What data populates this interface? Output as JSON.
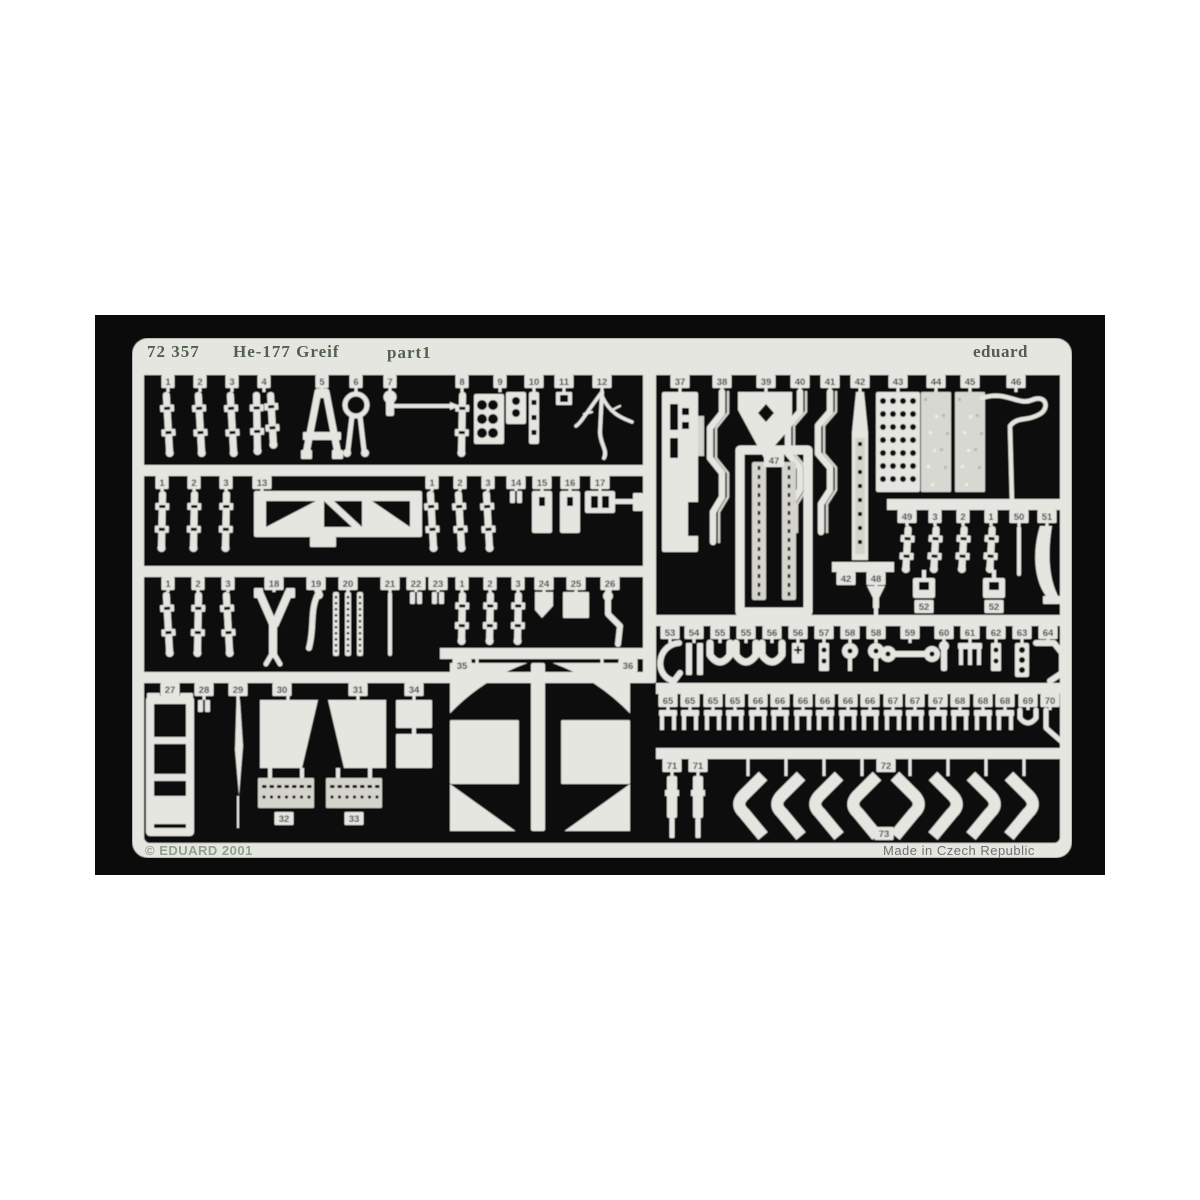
{
  "header": {
    "catalog_number": "72 357",
    "title": "He-177 Greif",
    "part_label": "part1",
    "brand": "eduard"
  },
  "footer": {
    "copyright": "© EDUARD 2001",
    "made_in": "Made in Czech Republic"
  },
  "colors": {
    "page_bg": "#ffffff",
    "photo_bg": "#0b0b0b",
    "metal": "#e6e6e1",
    "metal_dim": "#d4d4cc",
    "etch_dark": "#101010",
    "header_text": "#525f52",
    "brand_text": "#545c54",
    "copyright_text": "#8fa08f",
    "origin_text": "#6f6f6f",
    "number_text": "#3c3c3c"
  },
  "fret": {
    "sheet": {
      "w": 940,
      "h": 520,
      "frame": 12,
      "top_band": 26,
      "bottom_band": 15,
      "corner_radius": 16
    },
    "extras": [
      {
        "k": "rect",
        "x": 511,
        "y": 26,
        "w": 13,
        "h": 319
      },
      {
        "k": "rect",
        "x": 399,
        "y": 325,
        "w": 14,
        "h": 168
      },
      {
        "k": "frame47",
        "n": "47",
        "x": 608,
        "y": 112,
        "w": 68,
        "h": 162
      }
    ],
    "rows": [
      {
        "name": "row-a",
        "rail": [
          12,
          26,
          916,
          11
        ],
        "partY": 54,
        "parts": [
          {
            "n": "1",
            "k": "strap",
            "cx": 36,
            "h": 64
          },
          {
            "n": "2",
            "k": "strap",
            "cx": 68,
            "h": 64
          },
          {
            "n": "3",
            "k": "strap",
            "cx": 100,
            "h": 64
          },
          {
            "n": "4",
            "k": "strap2",
            "cx": 132,
            "h": 62
          },
          {
            "n": "5",
            "k": "aframe",
            "cx": 190
          },
          {
            "n": "6",
            "k": "ring",
            "cx": 224
          },
          {
            "n": "7",
            "k": "lever",
            "cx": 258
          },
          {
            "n": "8",
            "k": "strap",
            "cx": 330,
            "h": 64
          },
          {
            "n": "9",
            "k": "panel",
            "cx": 368
          },
          {
            "n": "10",
            "k": "strip",
            "cx": 402
          },
          {
            "n": "11",
            "k": "box",
            "cx": 432
          },
          {
            "n": "12",
            "k": "tree",
            "cx": 470
          }
        ]
      },
      {
        "name": "row-b",
        "rail": [
          12,
          127,
          506,
          11
        ],
        "partY": 153,
        "parts": [
          {
            "n": "1",
            "k": "strap",
            "cx": 30,
            "h": 60
          },
          {
            "n": "2",
            "k": "strap",
            "cx": 62,
            "h": 60
          },
          {
            "n": "3",
            "k": "strap",
            "cx": 94,
            "h": 60
          },
          {
            "n": "13",
            "k": "truss",
            "x": 122,
            "w": 168,
            "h": 46,
            "tabCx": 130,
            "sx": 130
          },
          {
            "n": "1",
            "k": "strap",
            "cx": 300,
            "h": 60
          },
          {
            "n": "2",
            "k": "strap",
            "cx": 328,
            "h": 60
          },
          {
            "n": "3",
            "k": "strap",
            "cx": 356,
            "h": 60
          },
          {
            "n": "14",
            "k": "tiny",
            "cx": 384
          },
          {
            "n": "15",
            "k": "rectp",
            "cx": 410,
            "w": 20,
            "h": 42
          },
          {
            "n": "16",
            "k": "rectp",
            "cx": 438,
            "w": 20,
            "h": 42
          },
          {
            "n": "17",
            "k": "bracket17",
            "cx": 468
          }
        ]
      },
      {
        "name": "row-c",
        "rail": [
          12,
          228,
          506,
          11
        ],
        "partY": 254,
        "parts": [
          {
            "n": "1",
            "k": "strap",
            "cx": 36,
            "h": 64
          },
          {
            "n": "2",
            "k": "strap",
            "cx": 66,
            "h": 64
          },
          {
            "n": "3",
            "k": "strap",
            "cx": 96,
            "h": 64
          },
          {
            "n": "18",
            "k": "harnessY",
            "cx": 142
          },
          {
            "n": "19",
            "k": "bracket19",
            "cx": 184
          },
          {
            "n": "20",
            "k": "chain3",
            "cx": 216
          },
          {
            "n": "21",
            "k": "rod",
            "cx": 258,
            "h": 64
          },
          {
            "n": "22",
            "k": "tiny",
            "cx": 284
          },
          {
            "n": "23",
            "k": "tiny",
            "cx": 306
          },
          {
            "n": "1",
            "k": "strap",
            "cx": 330,
            "h": 52
          },
          {
            "n": "2",
            "k": "strap",
            "cx": 358,
            "h": 52
          },
          {
            "n": "3",
            "k": "strap",
            "cx": 386,
            "h": 52
          },
          {
            "n": "24",
            "k": "flag",
            "cx": 412
          },
          {
            "n": "25",
            "k": "box25",
            "cx": 444
          },
          {
            "n": "26",
            "k": "lever26",
            "cx": 478
          }
        ]
      },
      {
        "name": "row-d",
        "rail": [
          12,
          334,
          506,
          11
        ],
        "partY": 362,
        "parts": [
          {
            "n": "27",
            "k": "ladder27",
            "cx": 38,
            "h": 132
          },
          {
            "n": "28",
            "k": "tiny",
            "cx": 72
          },
          {
            "n": "29",
            "k": "blade",
            "cx": 106
          },
          {
            "n": "30",
            "k": "slantrect",
            "x": 128,
            "w": 58,
            "h": 68,
            "side": "r",
            "tabCx": 150,
            "sx": 156
          },
          {
            "n": "31",
            "k": "slantrect",
            "x": 196,
            "w": 58,
            "h": 68,
            "side": "l",
            "tabCx": 226,
            "sx": 226
          },
          {
            "n": "34",
            "k": "rects34",
            "cx": 282
          },
          {
            "n": "32",
            "k": "platetex",
            "x": 126,
            "w": 56,
            "h": 30,
            "y": 440,
            "labelY": 474,
            "tabCx": 152,
            "nostem": true
          },
          {
            "n": "33",
            "k": "platetex",
            "x": 194,
            "w": 56,
            "h": 30,
            "y": 440,
            "labelY": 474,
            "tabCx": 222,
            "nostem": true
          }
        ]
      },
      {
        "name": "row-x",
        "rail": [
          308,
          310,
          210,
          11
        ],
        "partY": 325,
        "parts": [
          {
            "n": "35",
            "k": "crosshalf",
            "x": 318,
            "w": 84,
            "h": 168,
            "d": 1,
            "tabCx": 330,
            "sx": 345
          },
          {
            "n": "36",
            "k": "crosshalf",
            "x": 414,
            "w": 84,
            "h": 168,
            "d": -1,
            "tabCx": 496,
            "sx": 470
          }
        ]
      },
      {
        "name": "row-e",
        "rail": [
          524,
          26,
          404,
          11
        ],
        "partY": 54,
        "parts": [
          {
            "n": "37",
            "k": "slotpanel",
            "cx": 548,
            "h": 160
          },
          {
            "n": "38",
            "k": "zigzag",
            "cx": 590,
            "h": 150
          },
          {
            "n": "39",
            "k": "pennant",
            "cx": 634
          },
          {
            "n": "40",
            "k": "zigzag",
            "cx": 668,
            "h": 140
          },
          {
            "n": "41",
            "k": "zigzag",
            "cx": 698,
            "h": 140
          },
          {
            "n": "42",
            "k": "taperholes",
            "cx": 728,
            "h": 168
          },
          {
            "n": "43",
            "k": "perfpanel",
            "cx": 766,
            "h": 100
          },
          {
            "n": "44",
            "k": "speckrect",
            "cx": 804,
            "h": 100
          },
          {
            "n": "45",
            "k": "speckrect",
            "cx": 838,
            "h": 100
          },
          {
            "n": "46",
            "k": "wire",
            "cx": 884
          }
        ]
      },
      {
        "name": "row-m",
        "rail": [
          700,
          224,
          62,
          10
        ],
        "partY": 248,
        "parts": [
          {
            "n": "42",
            "k": "none",
            "cx": 714
          },
          {
            "n": "48",
            "k": "funnel",
            "cx": 744
          }
        ]
      },
      {
        "name": "row-f",
        "rail": [
          755,
          161,
          173,
          11
        ],
        "partY": 188,
        "parts": [
          {
            "n": "49",
            "k": "strap",
            "cx": 775,
            "h": 46
          },
          {
            "n": "3",
            "k": "strap",
            "cx": 803,
            "h": 46
          },
          {
            "n": "2",
            "k": "strap",
            "cx": 831,
            "h": 46
          },
          {
            "n": "1",
            "k": "strap",
            "cx": 859,
            "h": 46
          },
          {
            "n": "50",
            "k": "rod",
            "cx": 887,
            "h": 50
          },
          {
            "n": "51",
            "k": "curveblade",
            "cx": 915
          }
        ]
      },
      {
        "name": "row-f2",
        "rail": null,
        "partY": 240,
        "parts": [
          {
            "n": "52",
            "k": "box52",
            "cx": 792,
            "y": 240,
            "labelY": 262
          },
          {
            "n": "52",
            "k": "box52",
            "cx": 862,
            "y": 240,
            "labelY": 262
          }
        ]
      },
      {
        "name": "row-g",
        "rail": [
          524,
          277,
          404,
          11
        ],
        "partY": 305,
        "parts": [
          {
            "n": "53",
            "k": "hook",
            "cx": 538
          },
          {
            "n": "54",
            "k": "bars",
            "cx": 562
          },
          {
            "n": "55",
            "k": "u",
            "cx": 588
          },
          {
            "n": "55",
            "k": "u",
            "cx": 614
          },
          {
            "n": "56",
            "k": "u",
            "cx": 640
          },
          {
            "n": "56",
            "k": "crossp",
            "cx": 666
          },
          {
            "n": "57",
            "k": "holes2",
            "cx": 692
          },
          {
            "n": "58",
            "k": "round",
            "cx": 718
          },
          {
            "n": "58",
            "k": "round",
            "cx": 744
          },
          {
            "n": "59",
            "k": "dumbbell",
            "cx": 778
          },
          {
            "n": "60",
            "k": "bar",
            "cx": 812
          },
          {
            "n": "61",
            "k": "fork",
            "cx": 838
          },
          {
            "n": "62",
            "k": "holes2",
            "cx": 864
          },
          {
            "n": "63",
            "k": "lights",
            "cx": 890
          },
          {
            "n": "64",
            "k": "angle",
            "cx": 916
          }
        ]
      },
      {
        "name": "row-h",
        "rail": [
          524,
          345,
          404,
          11
        ],
        "partY": 372,
        "parts": [
          {
            "n": "65",
            "k": "legs",
            "cx": 536
          },
          {
            "n": "65",
            "k": "legs",
            "cx": 558
          },
          {
            "n": "65",
            "k": "legs",
            "cx": 581
          },
          {
            "n": "65",
            "k": "legs",
            "cx": 603
          },
          {
            "n": "66",
            "k": "legs",
            "cx": 626
          },
          {
            "n": "66",
            "k": "legs",
            "cx": 648
          },
          {
            "n": "66",
            "k": "legs",
            "cx": 671
          },
          {
            "n": "66",
            "k": "legs",
            "cx": 693
          },
          {
            "n": "66",
            "k": "legs",
            "cx": 716
          },
          {
            "n": "66",
            "k": "legs",
            "cx": 738
          },
          {
            "n": "67",
            "k": "legs",
            "cx": 761
          },
          {
            "n": "67",
            "k": "legs",
            "cx": 783
          },
          {
            "n": "67",
            "k": "legs",
            "cx": 806
          },
          {
            "n": "68",
            "k": "legs",
            "cx": 828
          },
          {
            "n": "68",
            "k": "legs",
            "cx": 851
          },
          {
            "n": "68",
            "k": "legs",
            "cx": 873
          },
          {
            "n": "69",
            "k": "ujoint",
            "cx": 896
          },
          {
            "n": "70",
            "k": "bentpin",
            "cx": 918
          }
        ]
      },
      {
        "name": "row-i",
        "rail": [
          524,
          410,
          404,
          11
        ],
        "partY": 438,
        "parts": [
          {
            "n": "71",
            "k": "pin",
            "cx": 540
          },
          {
            "n": "71",
            "k": "pin",
            "cx": 566
          },
          {
            "n": "",
            "k": "chevron",
            "cx": 616,
            "d": 1
          },
          {
            "n": "",
            "k": "chevron",
            "cx": 654,
            "d": 1
          },
          {
            "n": "",
            "k": "chevron",
            "cx": 692,
            "d": 1
          },
          {
            "n": "",
            "k": "chevron",
            "cx": 730,
            "d": 1
          },
          {
            "n": "72",
            "k": "none",
            "cx": 754
          },
          {
            "n": "",
            "k": "chevron",
            "cx": 778,
            "d": -1
          },
          {
            "n": "",
            "k": "chevron",
            "cx": 816,
            "d": -1
          },
          {
            "n": "",
            "k": "chevron",
            "cx": 854,
            "d": -1
          },
          {
            "n": "",
            "k": "chevron",
            "cx": 892,
            "d": -1
          },
          {
            "n": "73",
            "k": "none",
            "cx": 752,
            "labelY": 489
          }
        ]
      }
    ]
  }
}
